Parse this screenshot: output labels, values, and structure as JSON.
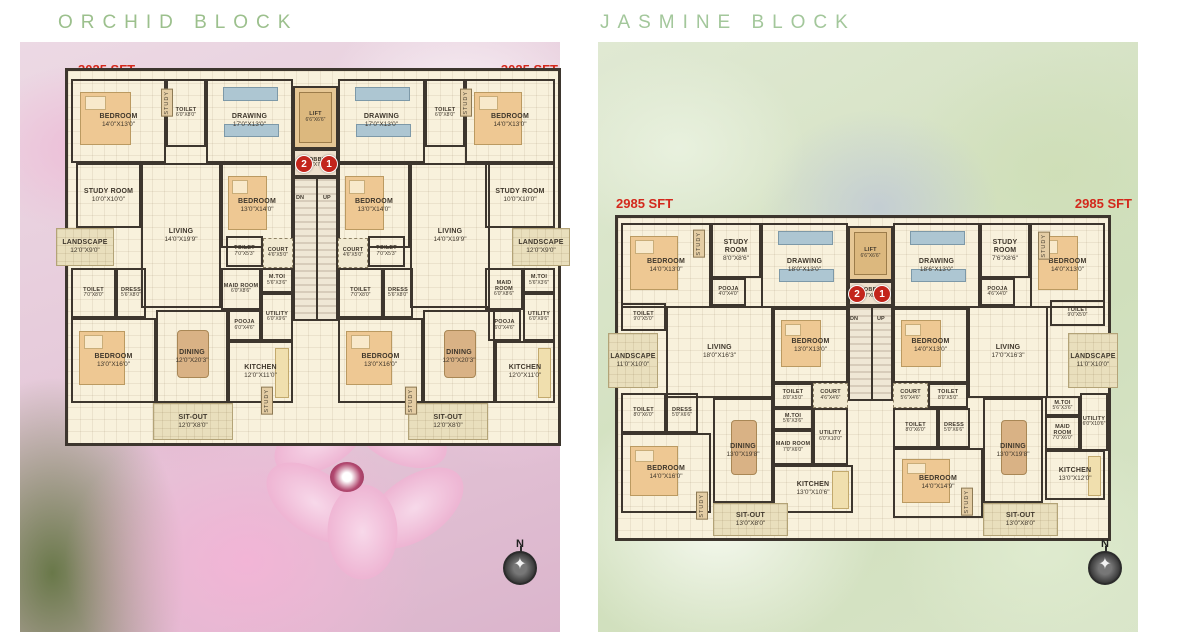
{
  "colors": {
    "title_green": "#9cc08d",
    "sft_red": "#d3281c",
    "wall": "#3d362e",
    "floor": "#f8f1dc",
    "unit_circle_red": "#c3251c"
  },
  "blocks": [
    {
      "id": "orchid",
      "title": "ORCHID BLOCK",
      "sft_left": "3025 SFT",
      "sft_right": "3025 SFT",
      "compass_n": "N",
      "stairs": {
        "dn": "DN",
        "up": "UP"
      },
      "plan": {
        "x": 65,
        "y": 68,
        "w": 490,
        "h": 372
      },
      "circles": [
        {
          "n": "2",
          "cx": 235,
          "cy": 92
        },
        {
          "n": "1",
          "cx": 260,
          "cy": 92
        }
      ],
      "updn": [
        {
          "t": "DN",
          "x": 228,
          "y": 124
        },
        {
          "t": "UP",
          "x": 255,
          "y": 124
        }
      ],
      "verticals": [
        {
          "l": "STUDY",
          "x": 93,
          "y": 18
        },
        {
          "l": "STUDY",
          "x": 392,
          "y": 18
        },
        {
          "l": "STUDY",
          "x": 193,
          "y": 316
        },
        {
          "l": "STUDY",
          "x": 337,
          "y": 316
        }
      ],
      "rooms": [
        {
          "l": "BEDROOM",
          "d": "14'0\"X13'0\"",
          "x": 3,
          "y": 8,
          "w": 95,
          "h": 84,
          "fx": "bed"
        },
        {
          "l": "TOILET",
          "d": "6'0\"X8'0\"",
          "x": 98,
          "y": 8,
          "w": 40,
          "h": 68
        },
        {
          "l": "DRAWING",
          "d": "17'0\"X13'0\"",
          "x": 138,
          "y": 8,
          "w": 87,
          "h": 84,
          "fx": "sofa"
        },
        {
          "l": "LIFT",
          "d": "6'6\"X6'6\"",
          "x": 225,
          "y": 15,
          "w": 45,
          "h": 63,
          "t": "lift"
        },
        {
          "l": "DRAWING",
          "d": "17'0\"X13'0\"",
          "x": 270,
          "y": 8,
          "w": 87,
          "h": 84,
          "fx": "sofa"
        },
        {
          "l": "TOILET",
          "d": "6'0\"X8'0\"",
          "x": 357,
          "y": 8,
          "w": 40,
          "h": 68
        },
        {
          "l": "BEDROOM",
          "d": "14'0\"X13'0\"",
          "x": 397,
          "y": 8,
          "w": 90,
          "h": 84,
          "fx": "bed"
        },
        {
          "l": "STUDY ROOM",
          "d": "10'0\"X10'0\"",
          "x": 8,
          "y": 92,
          "w": 65,
          "h": 65
        },
        {
          "l": "LIVING",
          "d": "14'0\"X19'9\"",
          "x": 73,
          "y": 92,
          "w": 80,
          "h": 145
        },
        {
          "l": "BEDROOM",
          "d": "13'0\"X14'0\"",
          "x": 153,
          "y": 92,
          "w": 72,
          "h": 85,
          "fx": "bed"
        },
        {
          "l": "LOBBY",
          "d": "8'0\"X7'0\"",
          "x": 225,
          "y": 78,
          "w": 45,
          "h": 28,
          "t": "lobby"
        },
        {
          "l": "",
          "d": "",
          "x": 225,
          "y": 106,
          "w": 45,
          "h": 144,
          "t": "stairs"
        },
        {
          "l": "BEDROOM",
          "d": "13'0\"X14'0\"",
          "x": 270,
          "y": 92,
          "w": 72,
          "h": 85,
          "fx": "bed"
        },
        {
          "l": "LIVING",
          "d": "14'0\"X19'9\"",
          "x": 342,
          "y": 92,
          "w": 80,
          "h": 145
        },
        {
          "l": "STUDY ROOM",
          "d": "10'0\"X10'0\"",
          "x": 417,
          "y": 92,
          "w": 70,
          "h": 65
        },
        {
          "l": "LANDSCAPE",
          "d": "12'0\"X9'0\"",
          "x": -12,
          "y": 157,
          "w": 58,
          "h": 38,
          "t": "open"
        },
        {
          "l": "LANDSCAPE",
          "d": "12'0\"X9'0\"",
          "x": 444,
          "y": 157,
          "w": 58,
          "h": 38,
          "t": "open"
        },
        {
          "l": "TOILET",
          "d": "7'0\"X5'3\"",
          "x": 158,
          "y": 165,
          "w": 37,
          "h": 31
        },
        {
          "l": "COURT",
          "d": "4'6\"X5'0\"",
          "x": 195,
          "y": 167,
          "w": 30,
          "h": 30,
          "t": "court"
        },
        {
          "l": "COURT",
          "d": "4'6\"X5'0\"",
          "x": 270,
          "y": 167,
          "w": 30,
          "h": 30,
          "t": "court"
        },
        {
          "l": "TOILET",
          "d": "7'0\"X5'3\"",
          "x": 300,
          "y": 165,
          "w": 37,
          "h": 31
        },
        {
          "l": "TOILET",
          "d": "7'0\"X8'0\"",
          "x": 3,
          "y": 197,
          "w": 45,
          "h": 50
        },
        {
          "l": "DRESS",
          "d": "5'6\"X8'0\"",
          "x": 48,
          "y": 197,
          "w": 30,
          "h": 50
        },
        {
          "l": "MAID ROOM",
          "d": "6'0\"X8'6\"",
          "x": 153,
          "y": 197,
          "w": 40,
          "h": 42
        },
        {
          "l": "M.TOI",
          "d": "5'6\"X3'6\"",
          "x": 193,
          "y": 197,
          "w": 32,
          "h": 25
        },
        {
          "l": "UTILITY",
          "d": "6'0\"X9'6\"",
          "x": 193,
          "y": 222,
          "w": 32,
          "h": 48
        },
        {
          "l": "POOJA",
          "d": "6'0\"X4'6\"",
          "x": 160,
          "y": 239,
          "w": 33,
          "h": 31
        },
        {
          "l": "BEDROOM",
          "d": "13'0\"X16'0\"",
          "x": 3,
          "y": 247,
          "w": 85,
          "h": 85,
          "fx": "bed"
        },
        {
          "l": "DINING",
          "d": "12'0\"X20'3\"",
          "x": 88,
          "y": 239,
          "w": 72,
          "h": 93,
          "fx": "table"
        },
        {
          "l": "KITCHEN",
          "d": "12'0\"X11'0\"",
          "x": 160,
          "y": 270,
          "w": 65,
          "h": 62,
          "fx": "kitchen"
        },
        {
          "l": "SIT-OUT",
          "d": "12'0\"X8'0\"",
          "x": 85,
          "y": 332,
          "w": 80,
          "h": 37,
          "t": "open"
        },
        {
          "l": "TOILET",
          "d": "7'0\"X8'0\"",
          "x": 270,
          "y": 197,
          "w": 45,
          "h": 50
        },
        {
          "l": "DRESS",
          "d": "5'6\"X8'0\"",
          "x": 315,
          "y": 197,
          "w": 30,
          "h": 50
        },
        {
          "l": "BEDROOM",
          "d": "13'0\"X16'0\"",
          "x": 270,
          "y": 247,
          "w": 85,
          "h": 85,
          "fx": "bed"
        },
        {
          "l": "DINING",
          "d": "12'0\"X20'3\"",
          "x": 355,
          "y": 239,
          "w": 72,
          "h": 93,
          "fx": "table"
        },
        {
          "l": "MAID ROOM",
          "d": "6'0\"X8'6\"",
          "x": 417,
          "y": 197,
          "w": 38,
          "h": 42
        },
        {
          "l": "M.TOI",
          "d": "5'6\"X3'6\"",
          "x": 455,
          "y": 197,
          "w": 32,
          "h": 25
        },
        {
          "l": "UTILITY",
          "d": "6'0\"X9'6\"",
          "x": 455,
          "y": 222,
          "w": 32,
          "h": 48
        },
        {
          "l": "POOJA",
          "d": "6'0\"X4'6\"",
          "x": 420,
          "y": 239,
          "w": 33,
          "h": 31
        },
        {
          "l": "KITCHEN",
          "d": "12'0\"X11'0\"",
          "x": 427,
          "y": 270,
          "w": 60,
          "h": 62,
          "fx": "kitchen"
        },
        {
          "l": "SIT-OUT",
          "d": "12'0\"X8'0\"",
          "x": 340,
          "y": 332,
          "w": 80,
          "h": 37,
          "t": "open"
        }
      ]
    },
    {
      "id": "jasmine",
      "title": "JASMINE BLOCK",
      "sft_left": "2985 SFT",
      "sft_right": "2985 SFT",
      "compass_n": "N",
      "stairs": {
        "dn": "DN",
        "up": "UP"
      },
      "plan": {
        "x": 615,
        "y": 215,
        "w": 490,
        "h": 320
      },
      "circles": [
        {
          "n": "2",
          "cx": 238,
          "cy": 75
        },
        {
          "n": "1",
          "cx": 263,
          "cy": 75
        }
      ],
      "updn": [
        {
          "t": "DN",
          "x": 232,
          "y": 98
        },
        {
          "t": "UP",
          "x": 259,
          "y": 98
        }
      ],
      "verticals": [
        {
          "l": "STUDY",
          "x": 75,
          "y": 12
        },
        {
          "l": "STUDY",
          "x": 420,
          "y": 14
        },
        {
          "l": "STUDY",
          "x": 78,
          "y": 274
        },
        {
          "l": "STUDY",
          "x": 343,
          "y": 270
        }
      ],
      "rooms": [
        {
          "l": "BEDROOM",
          "d": "14'0\"X13'0\"",
          "x": 3,
          "y": 5,
          "w": 90,
          "h": 85,
          "fx": "bed"
        },
        {
          "l": "STUDY ROOM",
          "d": "8'0\"X8'6\"",
          "x": 93,
          "y": 5,
          "w": 50,
          "h": 55
        },
        {
          "l": "POOJA",
          "d": "4'0\"X4'0\"",
          "x": 93,
          "y": 60,
          "w": 35,
          "h": 28
        },
        {
          "l": "DRAWING",
          "d": "18'0\"X13'0\"",
          "x": 143,
          "y": 5,
          "w": 87,
          "h": 85,
          "fx": "sofa"
        },
        {
          "l": "LIFT",
          "d": "6'6\"X6'6\"",
          "x": 230,
          "y": 8,
          "w": 45,
          "h": 55,
          "t": "lift"
        },
        {
          "l": "DRAWING",
          "d": "18'6\"X13'0\"",
          "x": 275,
          "y": 5,
          "w": 87,
          "h": 85,
          "fx": "sofa"
        },
        {
          "l": "STUDY ROOM",
          "d": "7'6\"X8'6\"",
          "x": 362,
          "y": 5,
          "w": 50,
          "h": 55
        },
        {
          "l": "POOJA",
          "d": "4'6\"X4'0\"",
          "x": 362,
          "y": 60,
          "w": 35,
          "h": 28
        },
        {
          "l": "BEDROOM",
          "d": "14'0\"X13'0\"",
          "x": 412,
          "y": 5,
          "w": 75,
          "h": 85,
          "fx": "bed"
        },
        {
          "l": "TOILET",
          "d": "9'0\"X5'0\"",
          "x": 3,
          "y": 85,
          "w": 45,
          "h": 28
        },
        {
          "l": "LANDSCAPE",
          "d": "11'0\"X10'0\"",
          "x": -10,
          "y": 115,
          "w": 50,
          "h": 55,
          "t": "open"
        },
        {
          "l": "LIVING",
          "d": "18'0\"X16'3\"",
          "x": 48,
          "y": 88,
          "w": 107,
          "h": 92
        },
        {
          "l": "BEDROOM",
          "d": "13'0\"X13'0\"",
          "x": 155,
          "y": 90,
          "w": 75,
          "h": 75,
          "fx": "bed"
        },
        {
          "l": "LOBBY",
          "d": "8'0\"X8'0\"",
          "x": 230,
          "y": 63,
          "w": 45,
          "h": 25,
          "t": "lobby"
        },
        {
          "l": "",
          "d": "",
          "x": 230,
          "y": 88,
          "w": 45,
          "h": 95,
          "t": "stairs"
        },
        {
          "l": "BEDROOM",
          "d": "14'0\"X13'0\"",
          "x": 275,
          "y": 90,
          "w": 75,
          "h": 75,
          "fx": "bed"
        },
        {
          "l": "LIVING",
          "d": "17'0\"X16'3\"",
          "x": 350,
          "y": 88,
          "w": 80,
          "h": 92
        },
        {
          "l": "TOILET",
          "d": "9'0\"X5'0\"",
          "x": 432,
          "y": 82,
          "w": 55,
          "h": 26
        },
        {
          "l": "LANDSCAPE",
          "d": "11'0\"X10'0\"",
          "x": 450,
          "y": 115,
          "w": 50,
          "h": 55,
          "t": "open"
        },
        {
          "l": "TOILET",
          "d": "8'0\"X5'0\"",
          "x": 155,
          "y": 165,
          "w": 40,
          "h": 25
        },
        {
          "l": "COURT",
          "d": "4'6\"X4'6\"",
          "x": 195,
          "y": 165,
          "w": 35,
          "h": 25,
          "t": "court"
        },
        {
          "l": "COURT",
          "d": "5'6\"X4'6\"",
          "x": 275,
          "y": 165,
          "w": 35,
          "h": 25,
          "t": "court"
        },
        {
          "l": "TOILET",
          "d": "8'0\"X5'0\"",
          "x": 310,
          "y": 165,
          "w": 40,
          "h": 25
        },
        {
          "l": "TOILET",
          "d": "8'0\"X6'0\"",
          "x": 3,
          "y": 175,
          "w": 45,
          "h": 40
        },
        {
          "l": "DRESS",
          "d": "5'0\"X6'6\"",
          "x": 48,
          "y": 175,
          "w": 32,
          "h": 40
        },
        {
          "l": "M.TOI",
          "d": "5'6\"X3'6\"",
          "x": 155,
          "y": 190,
          "w": 40,
          "h": 22
        },
        {
          "l": "MAID ROOM",
          "d": "7'0\"X6'0\"",
          "x": 155,
          "y": 212,
          "w": 40,
          "h": 35
        },
        {
          "l": "UTILITY",
          "d": "6'0\"X10'0\"",
          "x": 195,
          "y": 190,
          "w": 35,
          "h": 57
        },
        {
          "l": "BEDROOM",
          "d": "14'0\"X16'0\"",
          "x": 3,
          "y": 215,
          "w": 90,
          "h": 80,
          "fx": "bed"
        },
        {
          "l": "DINING",
          "d": "13'0\"X19'8\"",
          "x": 95,
          "y": 180,
          "w": 60,
          "h": 105,
          "fx": "table"
        },
        {
          "l": "KITCHEN",
          "d": "13'0\"X10'6\"",
          "x": 155,
          "y": 247,
          "w": 80,
          "h": 48,
          "fx": "kitchen"
        },
        {
          "l": "SIT-OUT",
          "d": "13'0\"X8'0\"",
          "x": 95,
          "y": 285,
          "w": 75,
          "h": 33,
          "t": "open"
        },
        {
          "l": "TOILET",
          "d": "8'0\"X6'0\"",
          "x": 275,
          "y": 190,
          "w": 45,
          "h": 40
        },
        {
          "l": "DRESS",
          "d": "5'0\"X6'6\"",
          "x": 320,
          "y": 190,
          "w": 32,
          "h": 40
        },
        {
          "l": "BEDROOM",
          "d": "14'0\"X14'9\"",
          "x": 275,
          "y": 230,
          "w": 90,
          "h": 70,
          "fx": "bed"
        },
        {
          "l": "DINING",
          "d": "13'0\"X19'8\"",
          "x": 365,
          "y": 180,
          "w": 60,
          "h": 105,
          "fx": "table"
        },
        {
          "l": "M.TOI",
          "d": "5'6\"X3'6\"",
          "x": 427,
          "y": 178,
          "w": 35,
          "h": 20
        },
        {
          "l": "MAID ROOM",
          "d": "7'0\"X6'0\"",
          "x": 427,
          "y": 198,
          "w": 35,
          "h": 34
        },
        {
          "l": "UTILITY",
          "d": "6'0\"X10'6\"",
          "x": 462,
          "y": 175,
          "w": 28,
          "h": 58
        },
        {
          "l": "KITCHEN",
          "d": "13'0\"X12'0\"",
          "x": 427,
          "y": 232,
          "w": 60,
          "h": 50,
          "fx": "kitchen"
        },
        {
          "l": "SIT-OUT",
          "d": "13'0\"X8'0\"",
          "x": 365,
          "y": 285,
          "w": 75,
          "h": 33,
          "t": "open"
        }
      ]
    }
  ]
}
